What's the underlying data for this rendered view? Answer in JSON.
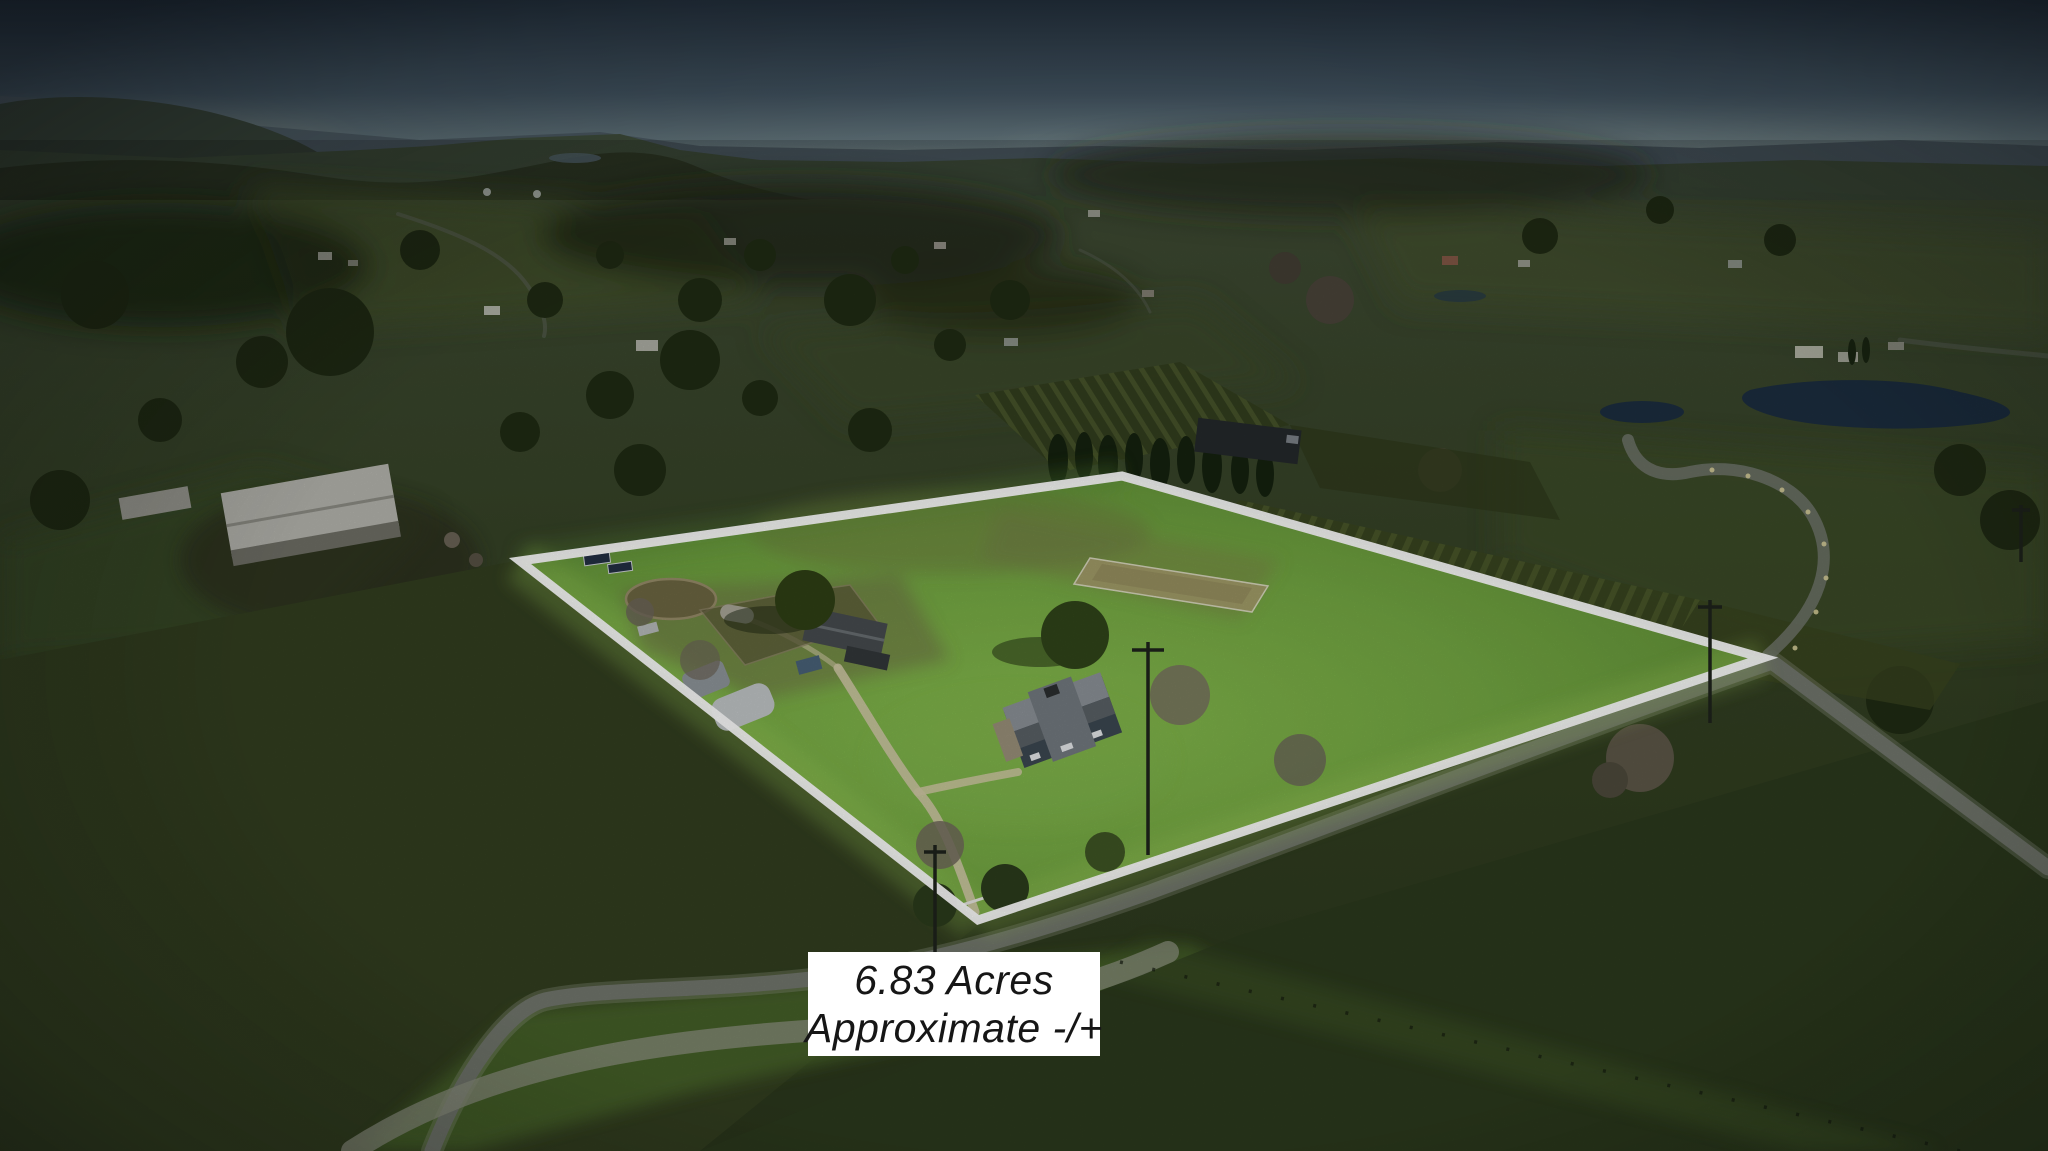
{
  "overlay": {
    "acreage_label": {
      "line1": "6.83 Acres",
      "line2": "Approximate -/+"
    }
  },
  "property": {
    "boundary_points": "520,561 1122,476 1763,658 978,920",
    "boundary_color": "#ffffff",
    "boundary_stroke_width": "9"
  },
  "colors": {
    "label_background": "#ffffff",
    "label_text": "#161616",
    "sky_top": "#222e3a",
    "sky_horizon": "#7e8b87",
    "land_dark": "#2e3a1e",
    "parcel_grass": "#74a843",
    "parcel_grass_bright": "#8fc24d",
    "road_gray": "#72776d",
    "water_blue": "#1c2e40"
  }
}
